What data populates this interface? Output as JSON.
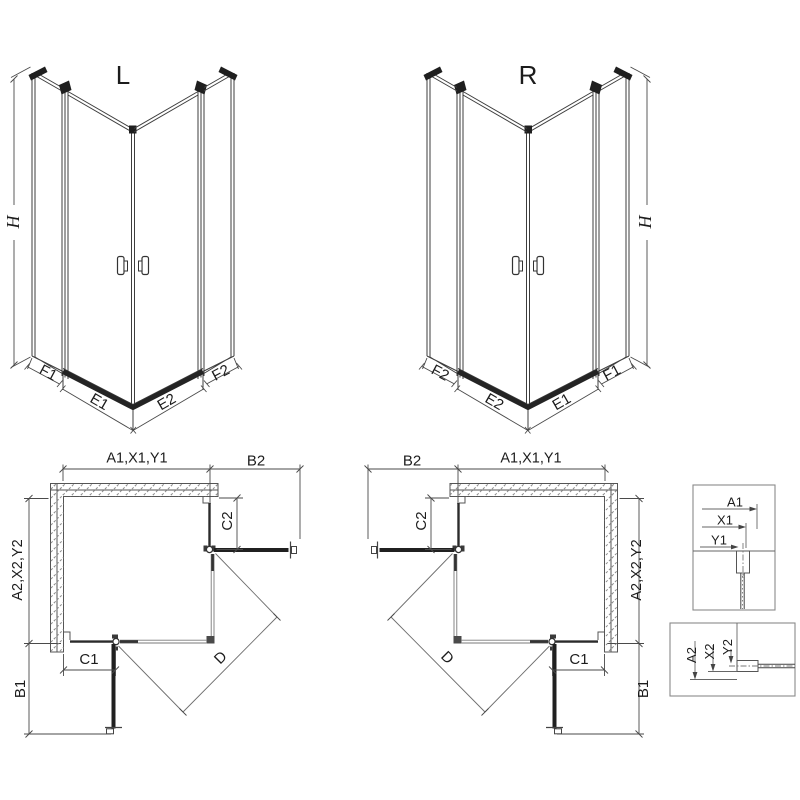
{
  "drawing": {
    "iso_left": {
      "title": "L",
      "height_label": "H",
      "segment_labels": [
        "F1",
        "E1",
        "E2",
        "F2"
      ]
    },
    "iso_right": {
      "title": "R",
      "height_label": "H",
      "segment_labels": [
        "F2",
        "E2",
        "E1",
        "F1"
      ]
    },
    "plan_left": {
      "width_label": "A1,X1,Y1",
      "return_top_label": "B2",
      "depth_label": "A2,X2,Y2",
      "return_bottom_label": "B1",
      "fixed_top_label": "C2",
      "fixed_bottom_label": "C1",
      "diagonal_label": "D"
    },
    "plan_right": {
      "width_label": "A1,X1,Y1",
      "return_top_label": "B2",
      "depth_label": "A2,X2,Y2",
      "return_bottom_label": "B1",
      "fixed_top_label": "C2",
      "fixed_bottom_label": "C1",
      "diagonal_label": "D"
    },
    "detail_top": {
      "dims": [
        "A1",
        "X1",
        "Y1"
      ]
    },
    "detail_bottom": {
      "dims": [
        "A2",
        "X2",
        "Y2"
      ]
    },
    "colors": {
      "line": "#3d3d3d",
      "panel": "#202020",
      "hatch": "#8a8a8a",
      "text": "#1c1c1c",
      "background": "#ffffff"
    }
  }
}
